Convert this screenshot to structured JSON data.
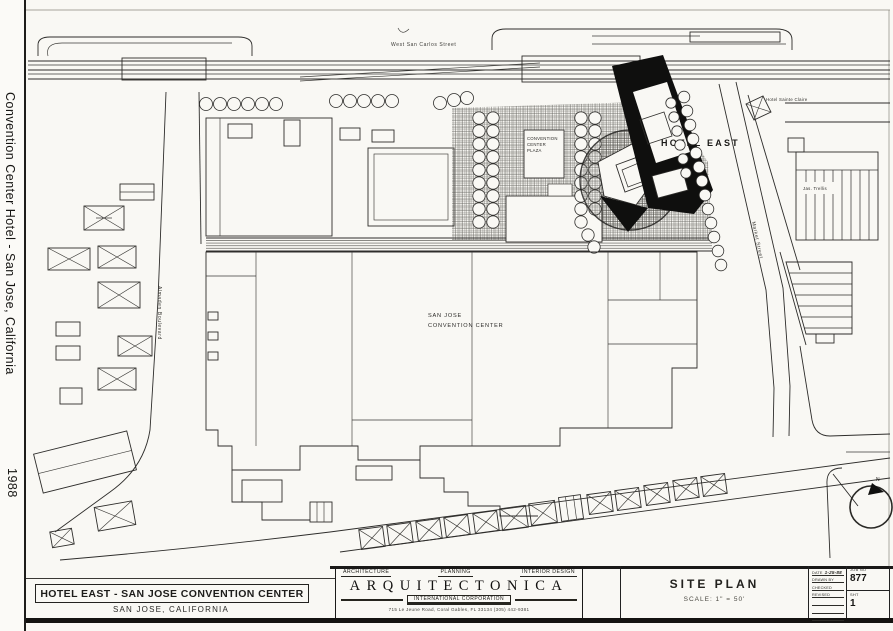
{
  "sidebar": {
    "title": "Convention Center Hotel - San Jose, California",
    "year": "1988"
  },
  "plan": {
    "street_top": "West San Carlos Street",
    "plaza_label": {
      "line1": "CONVENTION",
      "line2": "CENTER",
      "line3": "PLAZA"
    },
    "hotel_east_label": "HOTEL EAST",
    "hotel_sainte_claire_label": "Hotel Sainte Claire",
    "trellis_label": "Jas. Trellis",
    "cc_label": {
      "line1": "SAN JOSE",
      "line2": "CONVENTION CENTER"
    },
    "almaden_label": "Almaden Boulevard",
    "market_label": "Market Street",
    "north_label": "N"
  },
  "titleblock": {
    "project": {
      "title": "HOTEL EAST - SAN JOSE CONVENTION CENTER",
      "location": "SAN JOSE, CALIFORNIA"
    },
    "firm": {
      "left": "ARCHITECTURE",
      "center": "PLANNING",
      "right": "INTERIOR DESIGN",
      "name": "ARQUITECTONICA",
      "subtitle": "INTERNATIONAL CORPORATION",
      "address": "715 Le Jeune Road, Coral Gables, FL 33134 (305) 442-9381"
    },
    "sheet": {
      "title": "SITE PLAN",
      "scale": "SCALE: 1\" = 50'"
    },
    "info": {
      "date_label": "DATE",
      "date_value": "1-25-88",
      "drawn_label": "DRAWN BY",
      "checked_label": "CHECKED",
      "revised_label": "REVISED"
    },
    "job": {
      "job_label": "JOB NO",
      "job_value": "877",
      "sheet_label": "SHT",
      "sheet_value": "1"
    }
  },
  "colors": {
    "paper": "#f9f8f4",
    "ink": "#2e2d2b",
    "black": "#0f0f0e"
  }
}
